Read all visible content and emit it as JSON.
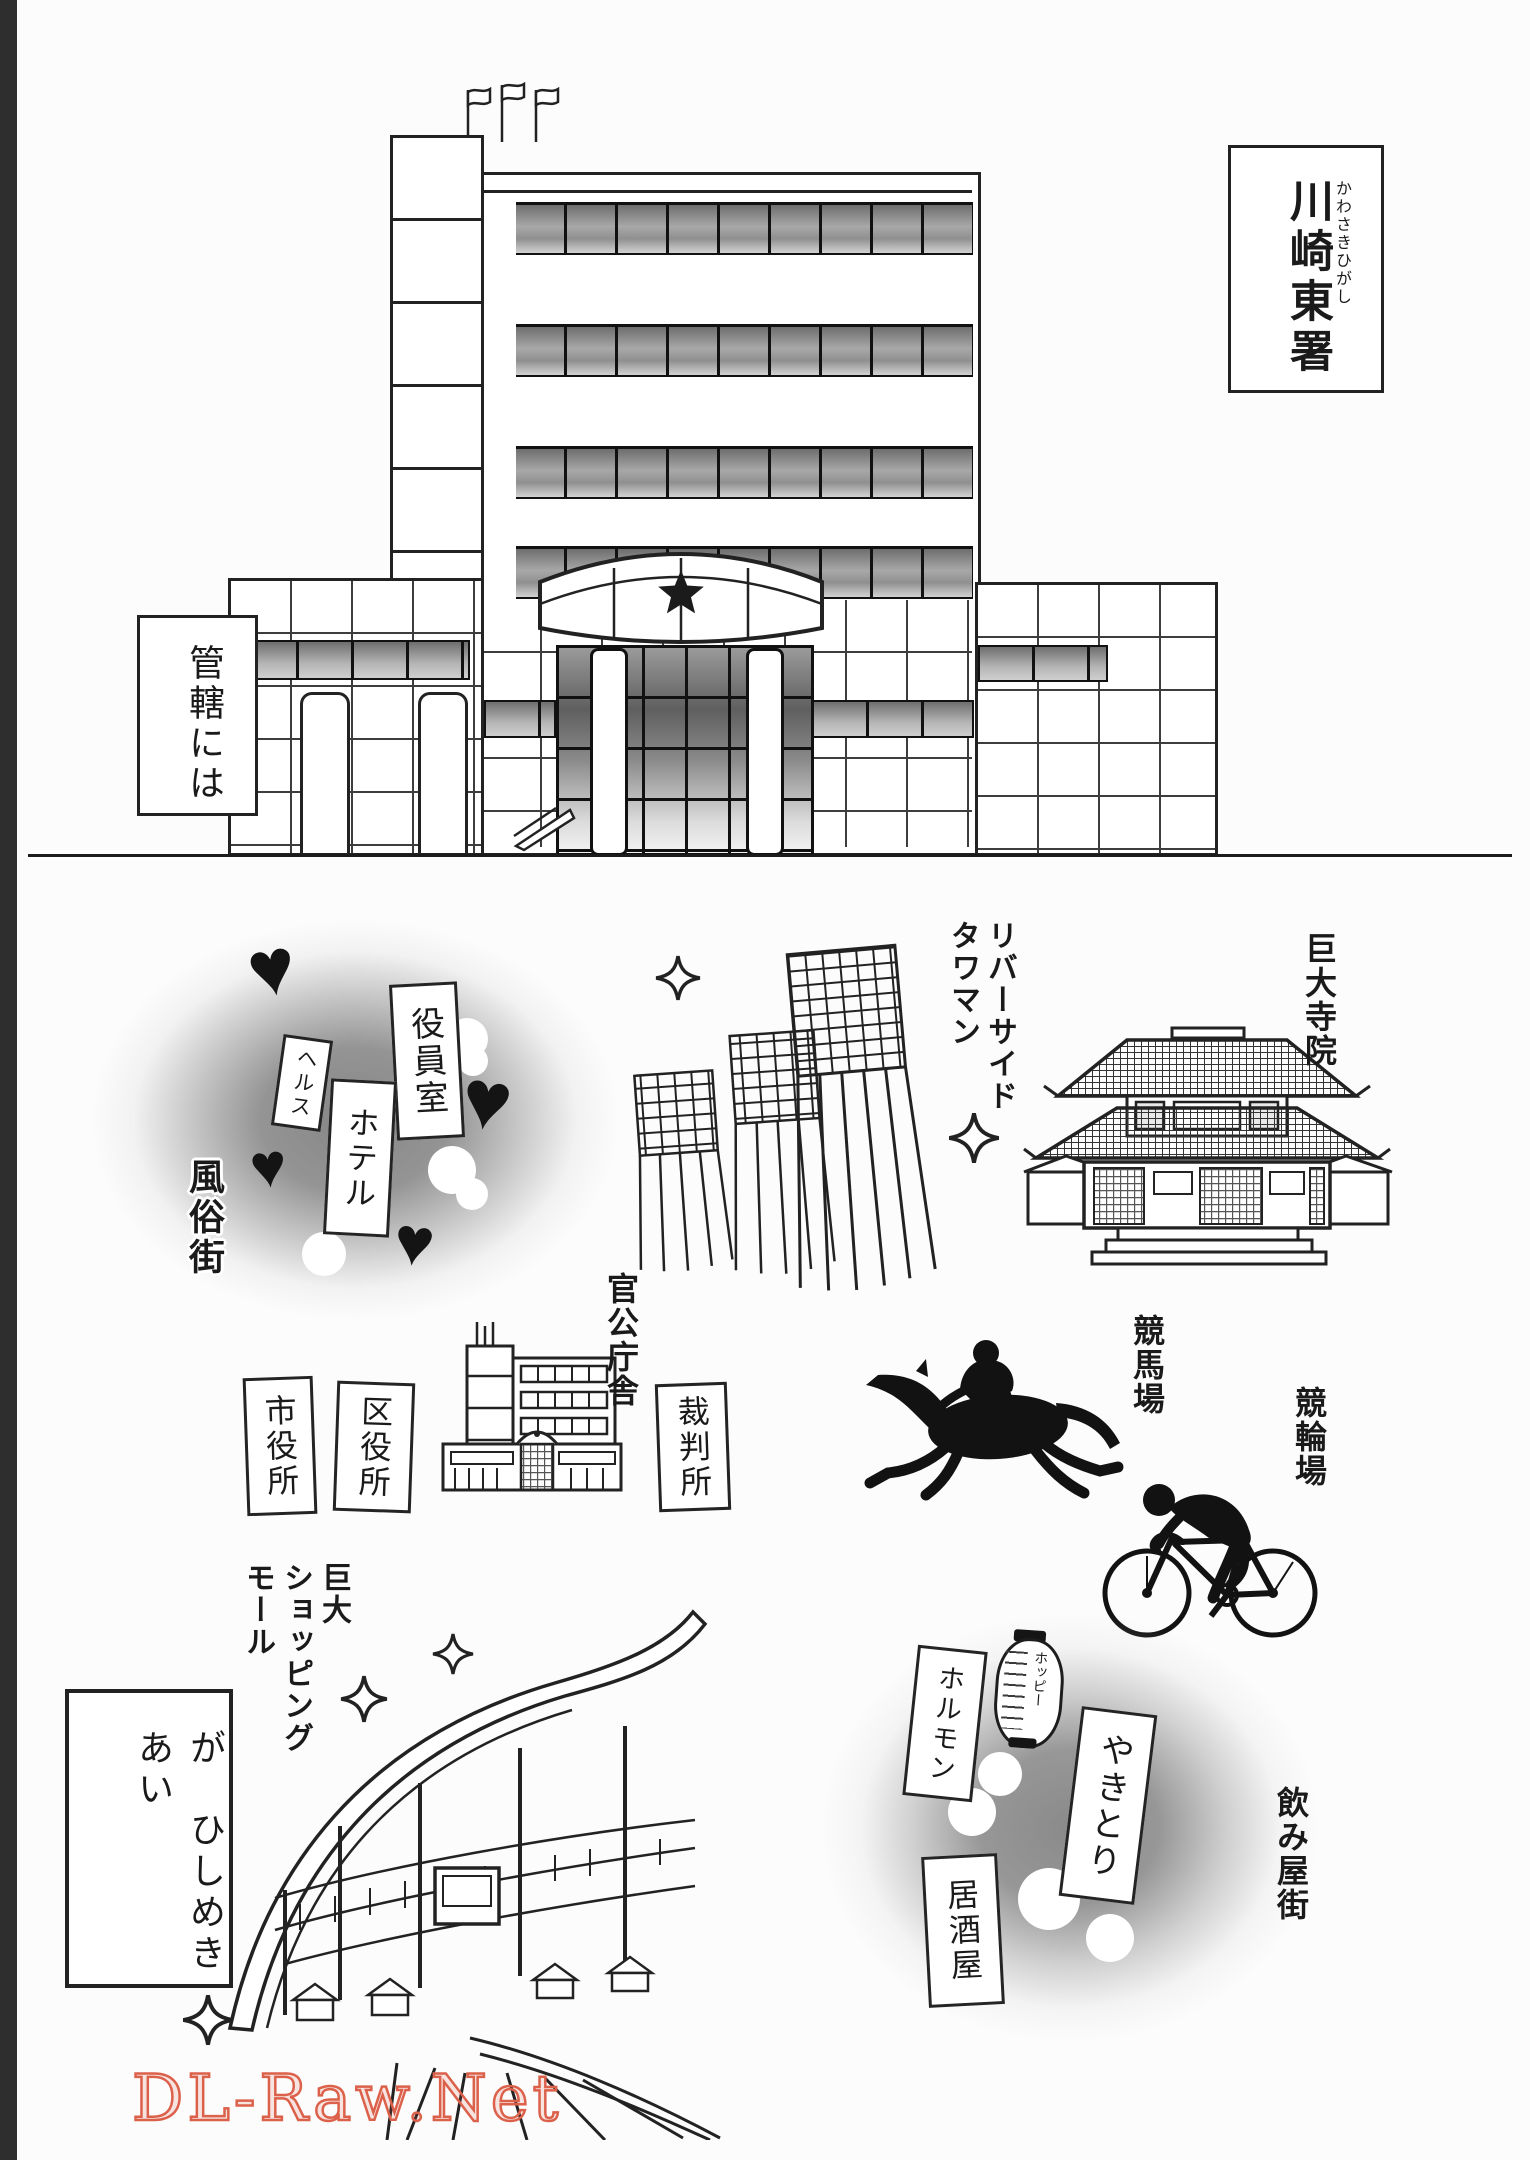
{
  "page": {
    "watermark": "DL-Raw.Net",
    "watermark_color": "#dc614b"
  },
  "top_panel": {
    "left_caption": "管轄には",
    "station_sign": {
      "name": "川崎東署",
      "furigana": "かわさきひがし"
    }
  },
  "map_panel": {
    "red_light": {
      "area": "風俗街",
      "sign_yakuin": "役員室",
      "sign_health": "ヘルス",
      "sign_hotel": "ホテル",
      "heart_glyph": "♥"
    },
    "towers_label": "リバーサイド\nタワマン",
    "temple_label": "巨大寺院",
    "government": {
      "label": "官公庁舎",
      "sign_city_hall": "市役所",
      "sign_ward_office": "区役所",
      "sign_court": "裁判所"
    },
    "keiba_label": "競馬場",
    "keirin_label": "競輪場",
    "mall_label": "巨大\nショッピング\nモール",
    "caption_box": "が　ひしめきあい",
    "drink_town": {
      "area": "飲み屋街",
      "sign_horumon": "ホルモン",
      "lantern": "ホッピー",
      "sign_yakitori": "やきとり",
      "sign_izakaya": "居酒屋"
    }
  }
}
